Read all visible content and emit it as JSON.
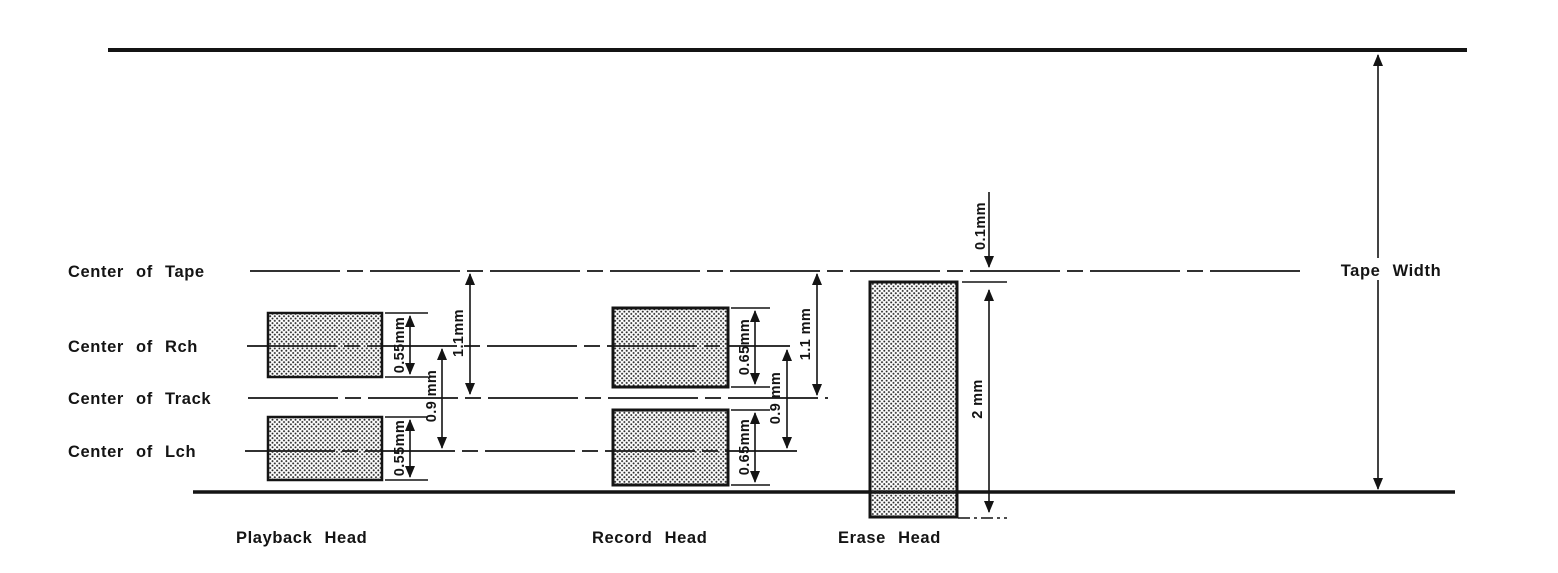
{
  "labels": {
    "center_of_tape": "Center of Tape",
    "center_of_rch": "Center of Rch",
    "center_of_track": "Center of Track",
    "center_of_lch": "Center of Lch",
    "playback_head": "Playback Head",
    "record_head": "Record Head",
    "erase_head": "Erase Head",
    "tape_width": "Tape Width"
  },
  "dims": {
    "playback_rch_track_width": "0.55mm",
    "playback_lch_track_width": "0.55mm",
    "playback_track_pitch": "0.9 mm",
    "playback_tape_center_offset": "1.1mm",
    "record_rch_track_width": "0.65mm",
    "record_lch_track_width": "0.65mm",
    "record_track_pitch": "0.9 mm",
    "record_tape_center_offset": "1.1 mm",
    "erase_top_gap": "0.1mm",
    "erase_head_height": "2 mm"
  },
  "colors": {
    "ink": "#141414",
    "paper": "#ffffff"
  }
}
